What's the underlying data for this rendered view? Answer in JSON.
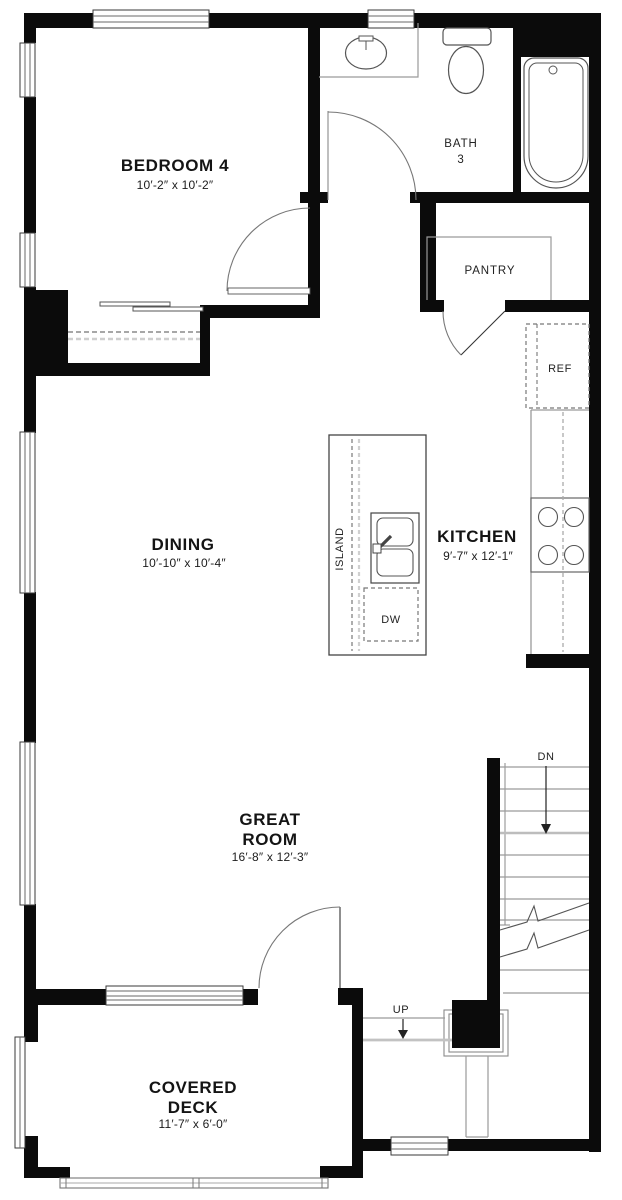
{
  "meta": {
    "type": "floor-plan"
  },
  "rooms": {
    "bedroom4": {
      "name": "BEDROOM 4",
      "dims": "10′-2″ x 10′-2″"
    },
    "bath3": {
      "name": "BATH\n3"
    },
    "pantry": {
      "name": "PANTRY"
    },
    "dining": {
      "name": "DINING",
      "dims": "10′-10″ x 10′-4″"
    },
    "kitchen": {
      "name": "KITCHEN",
      "dims": "9′-7″ x 12′-1″"
    },
    "great_room": {
      "name": "GREAT\nROOM",
      "dims": "16′-8″ x 12′-3″"
    },
    "covered_deck": {
      "name": "COVERED\nDECK",
      "dims": "11′-7″ x 6′-0″"
    }
  },
  "fixtures": {
    "island_label": "ISLAND",
    "dishwasher_label": "DW",
    "refrigerator_label": "REF"
  },
  "stairs": {
    "down_label": "DN",
    "up_label": "UP"
  },
  "colors": {
    "wall": "#0b0b0b",
    "text": "#141414",
    "fixture_line": "#8c8c8c",
    "background": "#ffffff"
  }
}
